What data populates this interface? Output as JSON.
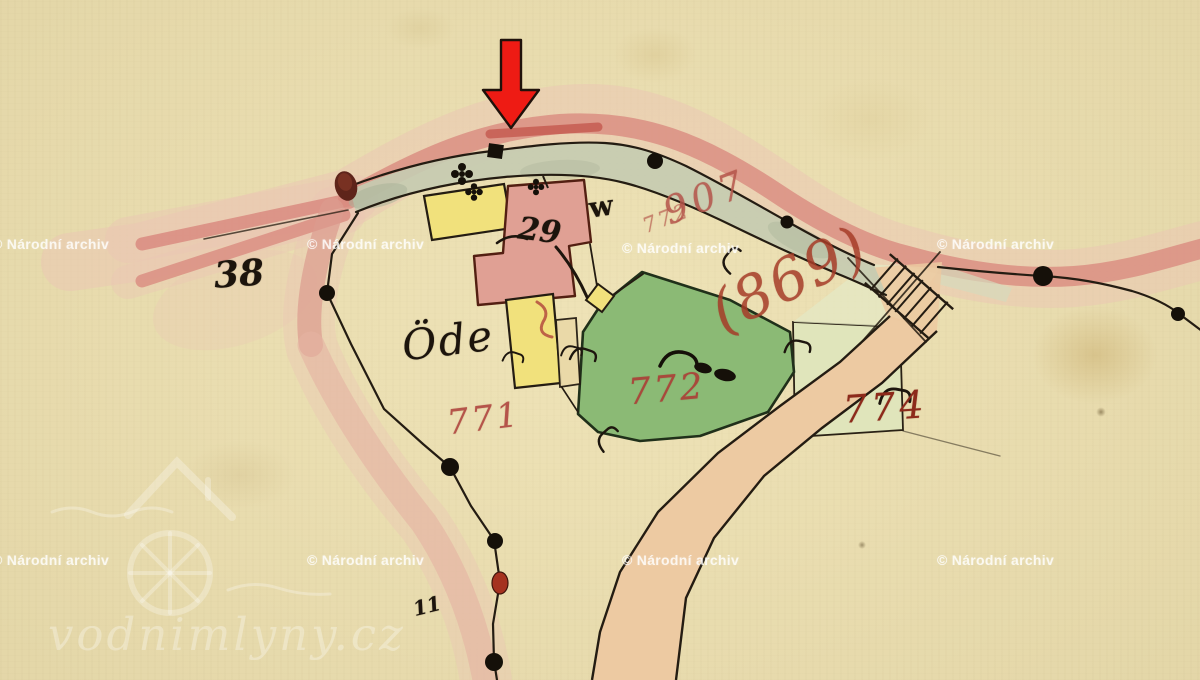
{
  "map": {
    "title": "historical hand-drawn cadastral map detail",
    "parcel_labels": {
      "p38": "38",
      "p771": "771",
      "p772": "772",
      "p774": "774",
      "p869": "(869)",
      "road907": "907",
      "road772": "772"
    },
    "annotations": {
      "building29": "29",
      "letter_w": "w",
      "ode": "Öde",
      "mark11": "11"
    },
    "marker": {
      "arrow": "red-down-arrow"
    },
    "colors": {
      "paper": "#e9dcab",
      "road_pink": "#d98b80",
      "road_halo": "#ecc6b4",
      "road_tan": "#edcaa2",
      "field_green": "#8bba75",
      "verge_green": "#c5cbb1",
      "parcel_green_light": "#e0e5bb",
      "building_yellow": "#f1e17c",
      "building_pink": "#e0a094",
      "ink_black": "#241c12",
      "label_red": "#b5544a",
      "label_dark_red": "#8d2a1b",
      "arrow_red": "#ee1b14"
    }
  },
  "watermarks": {
    "archive": "© Národní archiv",
    "site": "vodnimlyny.cz"
  }
}
